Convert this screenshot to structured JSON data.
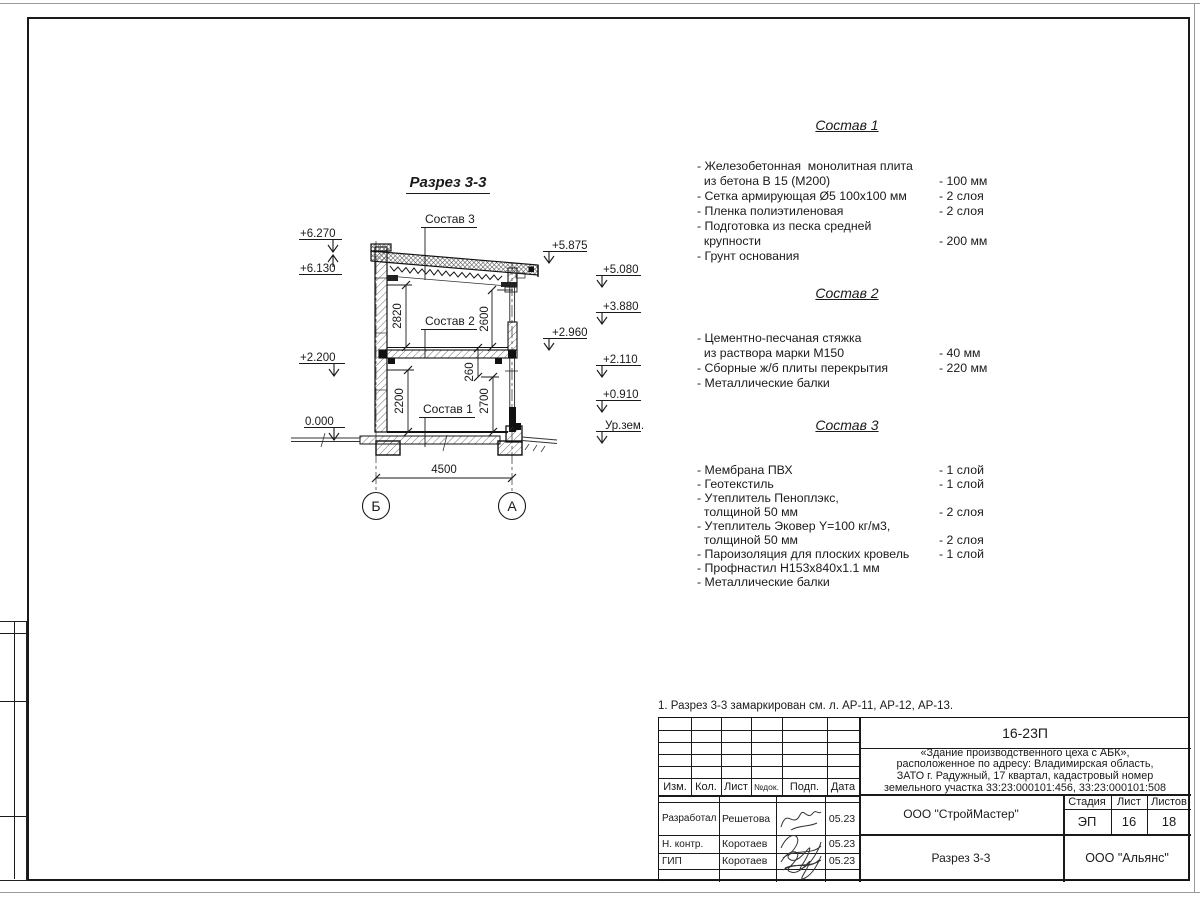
{
  "sheet": {
    "note": "1. Разрез 3-3 замаркирован см. л. АР-11, АР-12, АР-13."
  },
  "drawing": {
    "title": "Разрез 3-3",
    "sostav1_label": "Состав 1",
    "sostav2_label": "Состав 2",
    "sostav3_label": "Состав 3",
    "elev_left": [
      "+6.270",
      "+6.130",
      "+2.200",
      "0.000"
    ],
    "elev_right": [
      "+5.875",
      "+5.080",
      "+3.880",
      "+2.960",
      "+2.110",
      "+0.910",
      "Ур.зем."
    ],
    "dims": {
      "d2820": "2820",
      "d2600": "2600",
      "d2200": "2200",
      "d260": "260",
      "d2700": "2700",
      "d4500": "4500"
    },
    "axis_left": "Б",
    "axis_right": "А"
  },
  "compositions": [
    {
      "title": "Состав 1",
      "items": [
        {
          "text": "- Железобетонная  монолитная плита\n  из бетона В 15 (М200)",
          "value": "- 100 мм"
        },
        {
          "text": "- Сетка армирующая Ø5 100х100 мм",
          "value": "- 2 слоя"
        },
        {
          "text": "- Пленка полиэтиленовая",
          "value": "-  2 слоя"
        },
        {
          "text": "- Подготовка из песка средней\n  крупности",
          "value": "- 200 мм"
        },
        {
          "text": "- Грунт основания",
          "value": ""
        }
      ]
    },
    {
      "title": "Состав 2",
      "items": [
        {
          "text": "- Цементно-песчаная стяжка\n  из раствора марки М150",
          "value": "- 40 мм"
        },
        {
          "text": "- Сборные ж/б плиты перекрытия",
          "value": "- 220 мм"
        },
        {
          "text": "- Металлические балки",
          "value": ""
        }
      ]
    },
    {
      "title": "Состав 3",
      "items": [
        {
          "text": "- Мембрана ПВХ",
          "value": "- 1 слой"
        },
        {
          "text": "- Геотекстиль",
          "value": "- 1 слой"
        },
        {
          "text": "- Утеплитель Пеноплэкс,\n  толщиной 50 мм",
          "value": "- 2 слоя"
        },
        {
          "text": "- Утеплитель Эковер Y=100 кг/м3,\n  толщиной 50 мм",
          "value": "- 2 слоя"
        },
        {
          "text": "- Пароизоляция для плоских кровель",
          "value": "- 1 слой"
        },
        {
          "text": "- Профнастил Н153х840х1.1 мм",
          "value": ""
        },
        {
          "text": "- Металлические балки",
          "value": ""
        }
      ]
    }
  ],
  "titleblock": {
    "doc_number": "16-23П",
    "description": "«Здание производственного цеха с АБК»,\nрасположенное по адресу: Владимирская область,\nЗАТО г. Радужный, 17 квартал, кадастровый номер\nземельного участка 33:23:000101:456, 33:23:000101:508",
    "cols": [
      "Изм.",
      "Кол.",
      "Лист",
      "№док.",
      "Подп.",
      "Дата"
    ],
    "rows": [
      {
        "role": "Разработал",
        "name": "Решетова",
        "date": "05.23"
      },
      {
        "role": "Н. контр.",
        "name": "Коротаев",
        "date": "05.23"
      },
      {
        "role": "ГИП",
        "name": "Коротаев",
        "date": "05.23"
      }
    ],
    "org": "ООО \"СтройМастер\"",
    "sheet_name": "Разрез 3-3",
    "firm": "ООО \"Альянс\"",
    "stage_label": "Стадия",
    "list_label": "Лист",
    "listov_label": "Листов",
    "stage": "ЭП",
    "sheet_no": "16",
    "sheets_total": "18"
  }
}
